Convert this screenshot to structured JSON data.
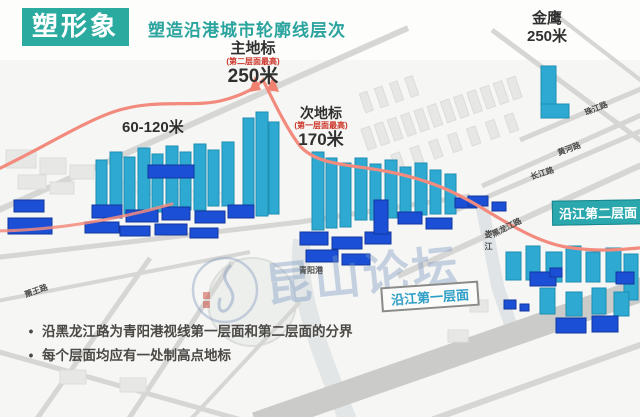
{
  "header": {
    "logo_text": "塑形象",
    "title": "塑造沿港城市轮廓线层次"
  },
  "landmarks": {
    "main": {
      "name": "主地标",
      "note": "(第二层面最高)",
      "height": "250米"
    },
    "secondary": {
      "name": "次地标",
      "note": "(第一层面最高)",
      "height": "170米"
    },
    "jinying": {
      "name": "金鹰",
      "height": "250米"
    },
    "range_label": "60-120米"
  },
  "zones": {
    "second_label": "沿江第二层面",
    "first_label": "沿江第一层面"
  },
  "roads": {
    "zhujiang": "珠江路",
    "huanghe": "黄河路",
    "changjiang": "长江路",
    "heilongjiang": "黑龙江路",
    "xiaowang": "萧王路"
  },
  "water": {
    "loujiang": "娄江",
    "qingyanggang": "青阳港"
  },
  "notes": {
    "bullet1": "沿黑龙江路为青阳港视线第一层面和第二层面的分界",
    "bullet2": "每个层面均应有一处制高点地标"
  },
  "watermark": {
    "text": "昆山论坛"
  },
  "colors": {
    "brand_teal": "#2BAB9F",
    "accent_red": "#CC3327",
    "skyline_line": "#F28B7D",
    "building_cyan": "#2EAAD2",
    "building_blue": "#1A4FD6",
    "zone_second_bg": "#2BA8AE",
    "zone_first_text": "#2E9FC6"
  }
}
